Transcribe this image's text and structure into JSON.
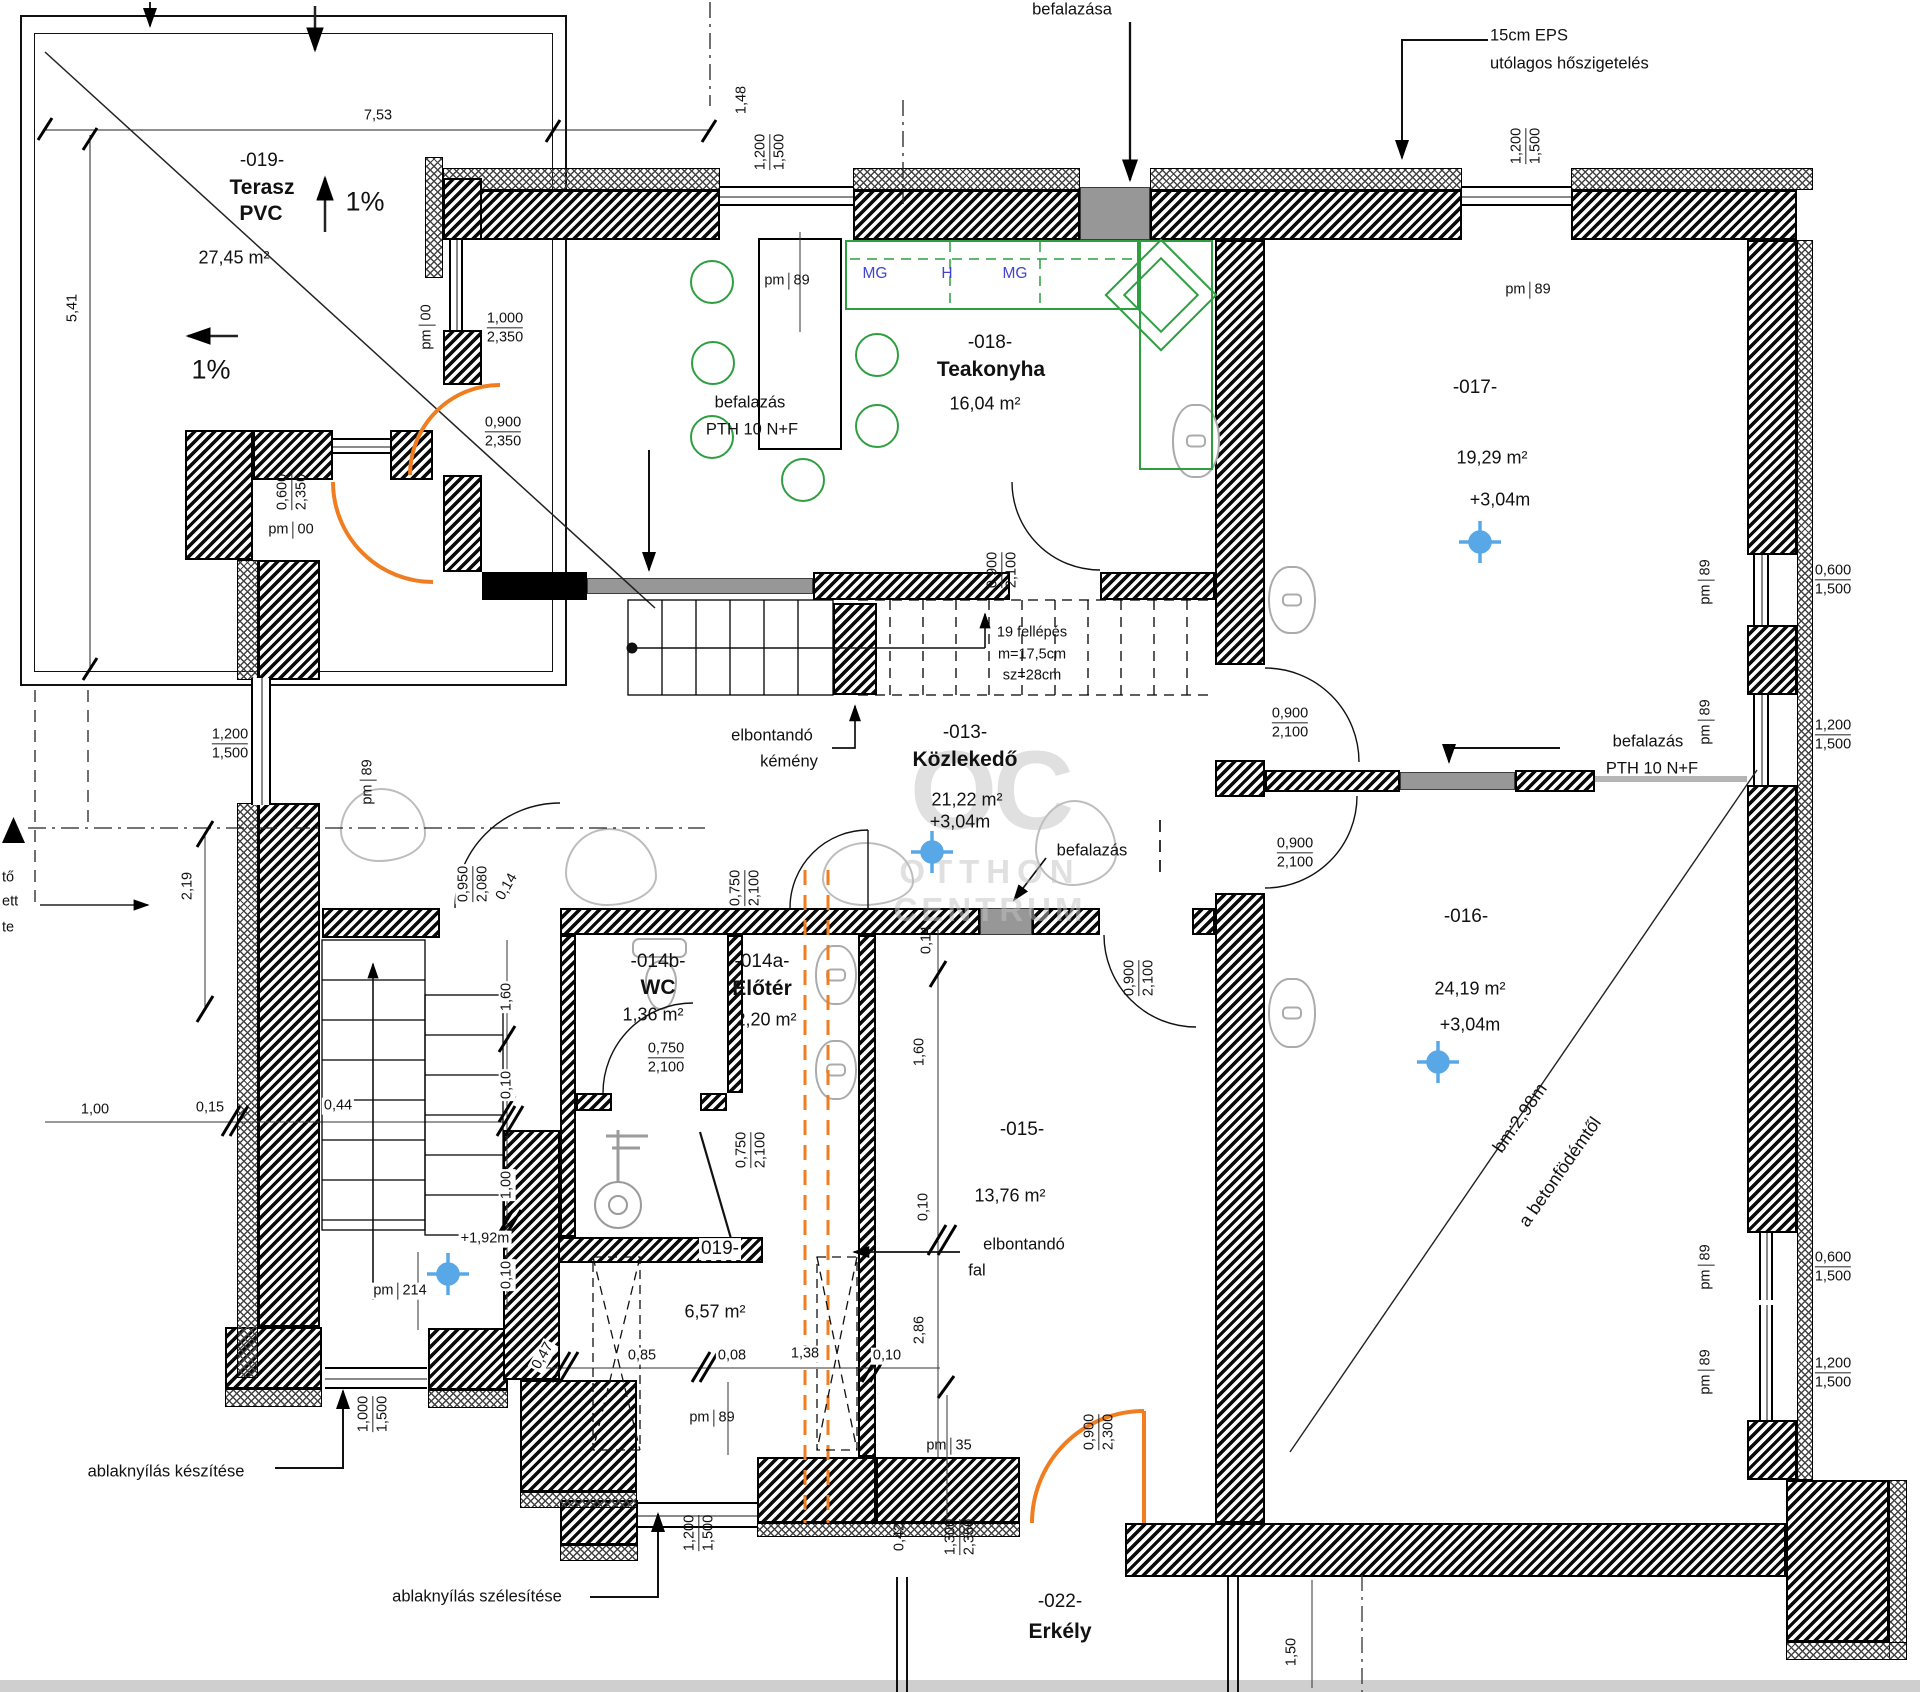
{
  "rooms": {
    "terasz": {
      "id": "-019-",
      "name": "Terasz",
      "name2": "PVC",
      "area": "27,45 m²",
      "slope": "1%"
    },
    "teakonyha": {
      "id": "-018-",
      "name": "Teakonyha",
      "area": "16,04 m²"
    },
    "r017": {
      "id": "-017-",
      "area": "19,29 m²",
      "level": "+3,04m"
    },
    "kozlekedo": {
      "id": "-013-",
      "name": "Közlekedő",
      "area": "21,22 m²",
      "level": "+3,04m"
    },
    "r016": {
      "id": "-016-",
      "area": "24,19 m²",
      "level": "+3,04m",
      "note1": "bm:2,98m",
      "note2": "a betonfödémtől"
    },
    "wc": {
      "id": "-014b-",
      "name": "WC",
      "area": "1,36 m²"
    },
    "eloter": {
      "id": "-014a-",
      "name": "Előtér",
      "area": "2,20 m²"
    },
    "r015": {
      "id": "-015-",
      "area": "13,76 m²"
    },
    "r019b": {
      "id": "019-",
      "area": "6,57 m²"
    },
    "erkely": {
      "id": "-022-",
      "name": "Erkély"
    }
  },
  "notes": {
    "befalazasa": "befalazása",
    "eps1": "15cm EPS",
    "eps2": "utólagos hőszigetelés",
    "befalazas": "befalazás",
    "pth": "PTH 10 N+F",
    "kemeny1": "elbontandó",
    "kemeny2": "kémény",
    "fal1": "elbontandó",
    "fal2": "fal",
    "stair1": "19 fellépés",
    "stair2": "m=17,5cm",
    "stair3": "sz=28cm",
    "ablak1": "ablaknyílás készítése",
    "ablak2": "ablaknyílás szélesítése",
    "frag1": "tő",
    "frag2": "ett",
    "frag3": "te",
    "lvl192": "+1,92m"
  },
  "kitchen": {
    "mg": "MG",
    "h": "H"
  },
  "dims": {
    "pm": "pm",
    "v00": "00",
    "v89": "89",
    "v214": "214",
    "v35": "35",
    "t753": "7,53",
    "t541": "5,41",
    "t148": "1,48",
    "t219": "2,19",
    "t286": "2,86",
    "w1000": "1,000",
    "w1200": "1,200",
    "w1300": "1,300",
    "w1500": "1,500",
    "w2080": "2,080",
    "w2100": "2,100",
    "w2300": "2,300",
    "w2350": "2,350",
    "w0600": "0,600",
    "w0750": "0,750",
    "w0900": "0,900",
    "w0950": "0,950",
    "c014": "0,14",
    "c160": "1,60",
    "c010": "0,10",
    "c100": "1,00",
    "c015": "0,15",
    "c044": "0,44",
    "c085": "0,85",
    "c008": "0,08",
    "c138": "1,38",
    "c047": "0,47",
    "c042": "0,42",
    "c150": "1,50"
  },
  "watermark": {
    "logo": "OC",
    "line1": "OTTHON",
    "line2": "CENTRUM"
  }
}
